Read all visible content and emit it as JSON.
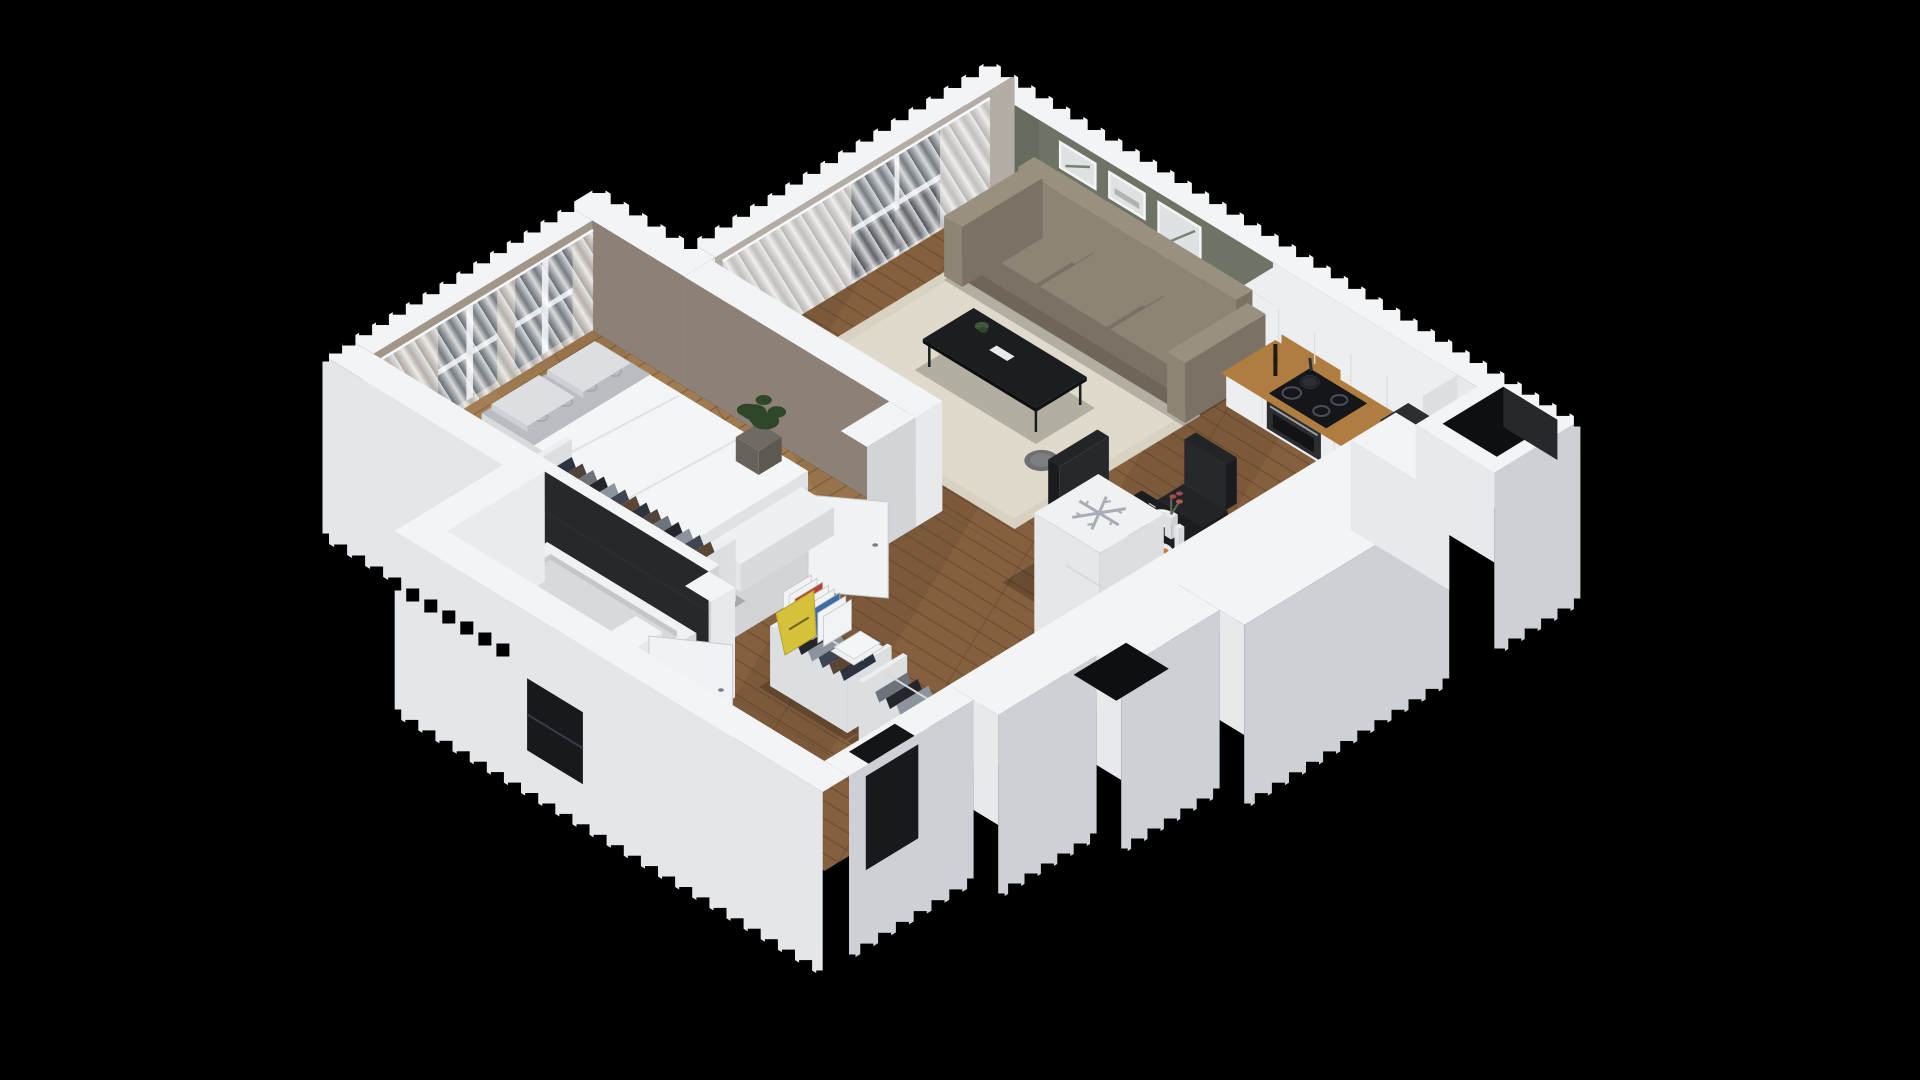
{
  "scene": {
    "type": "isometric-3d-floor-plan",
    "rooms": [
      "living-room",
      "kitchen",
      "dining-area",
      "bedroom",
      "hallway",
      "bathroom"
    ],
    "objects": [
      "sofa",
      "area-rug",
      "coffee-table",
      "side-table",
      "tv-panel",
      "gallery-wall-frames",
      "sheer-curtains",
      "balcony-door",
      "kitchen-upper-cabinets",
      "kitchen-base-cabinets",
      "wood-backsplash",
      "cooktop",
      "frying-pan",
      "oven",
      "coffee-machine",
      "pepper-grinders",
      "counter-sink",
      "kettle",
      "fridge-freezer",
      "snowflake-symbol",
      "dining-table",
      "dining-chairs",
      "plates",
      "fruit-bowl",
      "flower-vase",
      "bed",
      "pillows",
      "patterned-throw",
      "bed-bench",
      "potted-plant",
      "bedroom-window",
      "bedroom-wardrobe",
      "hall-wardrobes",
      "books-row",
      "magazine-stack",
      "leaning-sign",
      "bathtub",
      "vanity-sink",
      "tile-floor",
      "bathroom-door",
      "bedroom-door",
      "entry-recess",
      "utility-shaft",
      "window-openings",
      "stepped-render-edges"
    ]
  },
  "colors": {
    "background": "#000000",
    "wall_top": "#f3f4f6",
    "wall_face_light": "#e7e9ec",
    "wall_face_shade": "#d2d4d8",
    "skirt_left": "#e4e6e9",
    "skirt_right": "#cdd0d4",
    "living_accent_wall": "#6d7466",
    "living_accent_shade": "#5e6558",
    "living_side_wall": "#b4ada5",
    "bedroom_wall": "#8d8076",
    "bedroom_window_wall": "#a29689",
    "bath_dark_wall": "#26282a",
    "tile_wall": "#e9ebec",
    "wood_floor": "#84603e",
    "wood_floor_light": "#a07a50",
    "plank_line": "#5e422c",
    "bath_floor": "#efefec",
    "bath_motif": "#2e2e2e",
    "rug": "#d8d2c3",
    "rug_inner": "#e1dccd",
    "sofa": "#8e8476",
    "sofa_shade": "#7b7265",
    "sofa_light": "#99907f",
    "tv_black": "#121417",
    "table_black": "#1b1d20",
    "chair_black": "#222428",
    "metal": "#3a3d41",
    "counter_wood": "#b07d40",
    "counter_wood_dark": "#8f6230",
    "cabinet_white": "#eceef0",
    "cabinet_shade": "#dcdfe2",
    "appliance_dark": "#2b2d30",
    "cooktop_black": "#141619",
    "fridge_white": "#f0f1f3",
    "duvet": "#f4f5f6",
    "duvet_shade": "#e0e2e5",
    "pillow": "#dcdee1",
    "blanket": "#b9bcc0",
    "plant": "#3f5a38",
    "plant_dark": "#2e4629",
    "pot": "#6f6a63",
    "window_glass": "#41464b",
    "glass_dark": "#17191c",
    "door_white": "#f1f2f3",
    "clothes": [
      "#2c3240",
      "#50443a",
      "#6d727b",
      "#24262b",
      "#8d939c",
      "#3e4552",
      "#5a4632"
    ],
    "book_red": "#b5432f",
    "book_blue": "#3c6da5",
    "sign_yellow": "#d6c13a",
    "orange_fruit": "#d97a28",
    "plate_white": "#f2f2f2",
    "snow": "#a9aeb4",
    "shadow": "rgba(0,0,0,0.20)"
  }
}
